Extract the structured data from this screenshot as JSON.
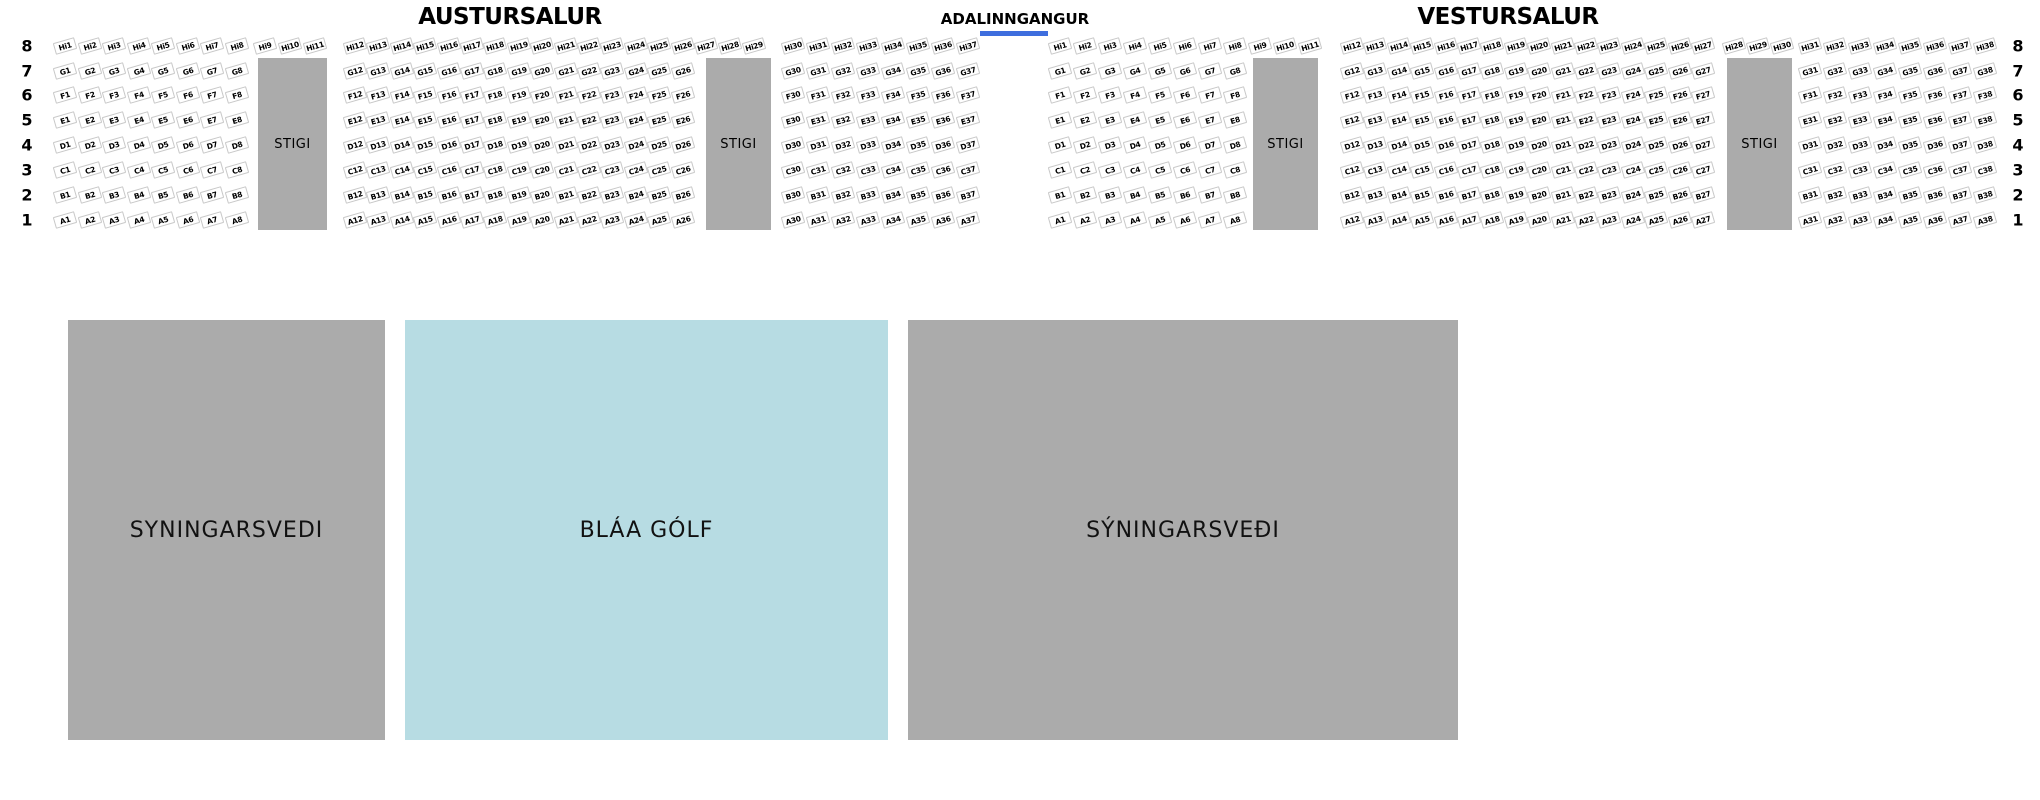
{
  "titles": {
    "east_hall": "AUSTURSALUR",
    "entrance": "ADALINNGANGUR",
    "west_hall": "VESTURSALUR"
  },
  "row_numbers": [
    "8",
    "7",
    "6",
    "5",
    "4",
    "3",
    "2",
    "1"
  ],
  "stairs_label": "STIGI",
  "halls": [
    {
      "id": "austursalur",
      "name": "AUSTURSALUR",
      "rows": [
        {
          "name": "Hi",
          "number": "8",
          "seat_ranges": [
            [
              1,
              37
            ]
          ]
        },
        {
          "name": "G",
          "number": "7",
          "seat_ranges": [
            [
              1,
              8
            ],
            [
              12,
              26
            ],
            [
              30,
              37
            ]
          ]
        },
        {
          "name": "F",
          "number": "6",
          "seat_ranges": [
            [
              1,
              8
            ],
            [
              12,
              26
            ],
            [
              30,
              37
            ]
          ]
        },
        {
          "name": "E",
          "number": "5",
          "seat_ranges": [
            [
              1,
              8
            ],
            [
              12,
              26
            ],
            [
              30,
              37
            ]
          ]
        },
        {
          "name": "D",
          "number": "4",
          "seat_ranges": [
            [
              1,
              8
            ],
            [
              12,
              26
            ],
            [
              30,
              37
            ]
          ]
        },
        {
          "name": "C",
          "number": "3",
          "seat_ranges": [
            [
              1,
              8
            ],
            [
              12,
              26
            ],
            [
              30,
              37
            ]
          ]
        },
        {
          "name": "B",
          "number": "2",
          "seat_ranges": [
            [
              1,
              8
            ],
            [
              12,
              26
            ],
            [
              30,
              37
            ]
          ]
        },
        {
          "name": "A",
          "number": "1",
          "seat_ranges": [
            [
              1,
              8
            ],
            [
              12,
              26
            ],
            [
              30,
              37
            ]
          ]
        }
      ]
    },
    {
      "id": "vestursalur",
      "name": "VESTURSALUR",
      "rows": [
        {
          "name": "Hi",
          "number": "8",
          "seat_ranges": [
            [
              1,
              38
            ]
          ]
        },
        {
          "name": "G",
          "number": "7",
          "seat_ranges": [
            [
              1,
              8
            ],
            [
              12,
              27
            ],
            [
              31,
              38
            ]
          ]
        },
        {
          "name": "F",
          "number": "6",
          "seat_ranges": [
            [
              1,
              8
            ],
            [
              12,
              27
            ],
            [
              31,
              38
            ]
          ]
        },
        {
          "name": "E",
          "number": "5",
          "seat_ranges": [
            [
              1,
              8
            ],
            [
              12,
              27
            ],
            [
              31,
              38
            ]
          ]
        },
        {
          "name": "D",
          "number": "4",
          "seat_ranges": [
            [
              1,
              8
            ],
            [
              12,
              27
            ],
            [
              31,
              38
            ]
          ]
        },
        {
          "name": "C",
          "number": "3",
          "seat_ranges": [
            [
              1,
              8
            ],
            [
              12,
              27
            ],
            [
              31,
              38
            ]
          ]
        },
        {
          "name": "B",
          "number": "2",
          "seat_ranges": [
            [
              1,
              8
            ],
            [
              12,
              27
            ],
            [
              31,
              38
            ]
          ]
        },
        {
          "name": "A",
          "number": "1",
          "seat_ranges": [
            [
              1,
              8
            ],
            [
              12,
              27
            ],
            [
              31,
              38
            ]
          ]
        }
      ]
    }
  ],
  "floor_areas": [
    {
      "id": "exhibition-left",
      "label": "SYNINGARSVEDI",
      "color": "#ababab"
    },
    {
      "id": "blue-floor",
      "label": "BLÁA GÓLF",
      "color": "#b7dce3"
    },
    {
      "id": "exhibition-right",
      "label": "SÝNINGARSVEÐI",
      "color": "#ababab"
    }
  ],
  "colors": {
    "stairs": "#ababab",
    "entrance_underline": "#3e6ede",
    "seat_border": "#c8c8c8"
  }
}
